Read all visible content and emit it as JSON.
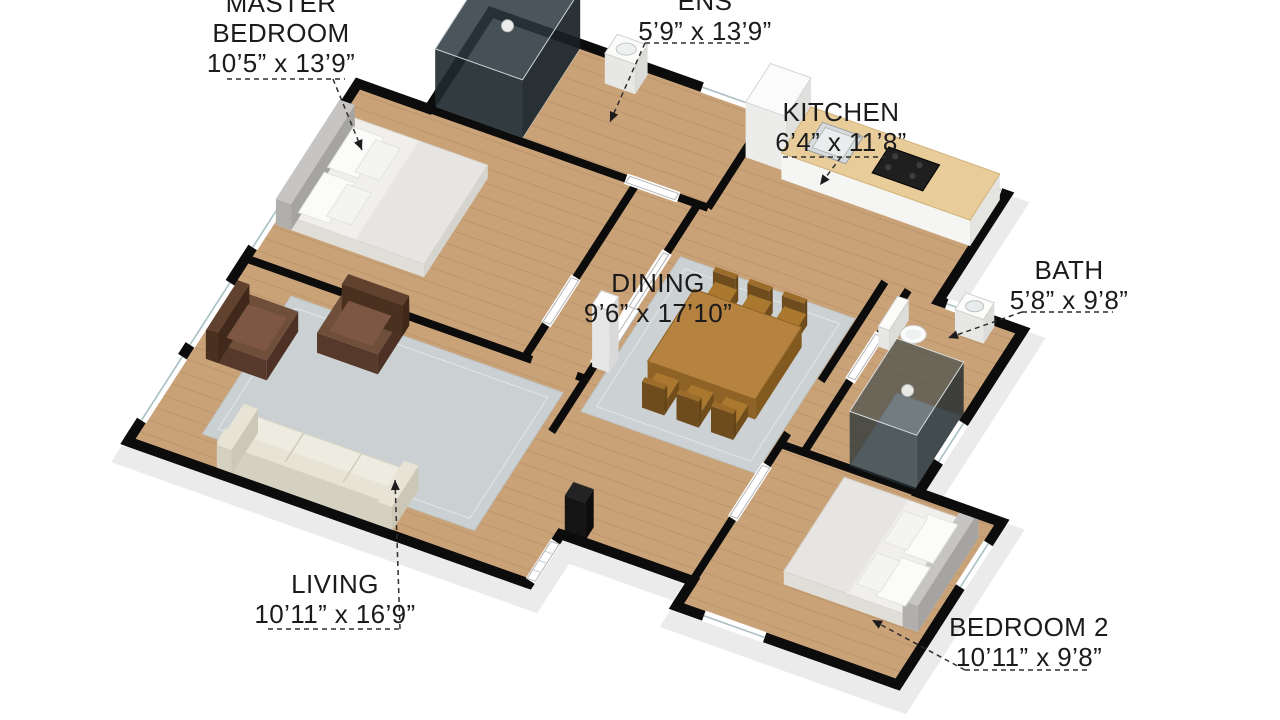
{
  "figure": {
    "kind": "3d-floor-plan",
    "background_color": "#ffffff",
    "label_text_color": "#1b1b1b",
    "wall_color": "#0c0c0c",
    "floor_wood_color": "#c9a278",
    "rug_color": "#ccd2d4",
    "counter_color": "#e8cd9b"
  },
  "rooms": [
    {
      "id": "master-bedroom",
      "name": "MASTER BEDROOM",
      "name_lines": [
        "MASTER",
        "BEDROOM"
      ],
      "dims": "10’5” x 13’9”",
      "label": {
        "cx": 281,
        "top": -12
      },
      "underline": [
        227,
        345,
        79
      ],
      "leader": [
        [
          333,
          79
        ],
        [
          362,
          150
        ]
      ]
    },
    {
      "id": "ens",
      "name": "ENS",
      "name_lines": [
        "ENS"
      ],
      "dims": "5’9” x 13’9”",
      "label": {
        "cx": 705,
        "top": -14
      },
      "underline": [
        645,
        752,
        43
      ],
      "leader": [
        [
          645,
          43
        ],
        [
          610,
          122
        ]
      ]
    },
    {
      "id": "kitchen",
      "name": "KITCHEN",
      "name_lines": [
        "KITCHEN"
      ],
      "dims": "6’4” x 11’8”",
      "label": {
        "cx": 841,
        "top": 97
      },
      "underline": [
        783,
        893,
        157
      ],
      "leader": [
        [
          841,
          157
        ],
        [
          820,
          185
        ]
      ]
    },
    {
      "id": "bath",
      "name": "BATH",
      "name_lines": [
        "BATH"
      ],
      "dims": "5’8” x 9’8”",
      "label": {
        "cx": 1069,
        "top": 255
      },
      "underline": [
        1022,
        1113,
        312
      ],
      "leader": [
        [
          1022,
          312
        ],
        [
          948,
          338
        ]
      ]
    },
    {
      "id": "dining",
      "name": "DINING",
      "name_lines": [
        "DINING"
      ],
      "dims": "9’6” x 17’10”",
      "label": {
        "cx": 658,
        "top": 268
      },
      "underline": null,
      "leader": null
    },
    {
      "id": "living",
      "name": "LIVING",
      "name_lines": [
        "LIVING"
      ],
      "dims": "10’11” x 16’9”",
      "label": {
        "cx": 335,
        "top": 569
      },
      "underline": [
        268,
        400,
        629
      ],
      "leader": [
        [
          400,
          629
        ],
        [
          395,
          480
        ]
      ]
    },
    {
      "id": "bedroom-2",
      "name": "BEDROOM 2",
      "name_lines": [
        "BEDROOM 2"
      ],
      "dims": "10’11” x 9’8”",
      "label": {
        "cx": 1029,
        "top": 612
      },
      "underline": [
        965,
        1088,
        670
      ],
      "leader": [
        [
          965,
          670
        ],
        [
          872,
          620
        ]
      ]
    }
  ],
  "furniture": [
    "ens-shower",
    "ens-sink",
    "fridge",
    "kitchen-counter",
    "kitchen-sink",
    "cooktop",
    "master-bed",
    "toilet",
    "bath-sink",
    "bath-shower",
    "dining-table",
    "dining-chairs",
    "column",
    "armchair",
    "armchair",
    "fireplace",
    "sofa",
    "bed-2",
    "dining-rug",
    "living-rug"
  ]
}
